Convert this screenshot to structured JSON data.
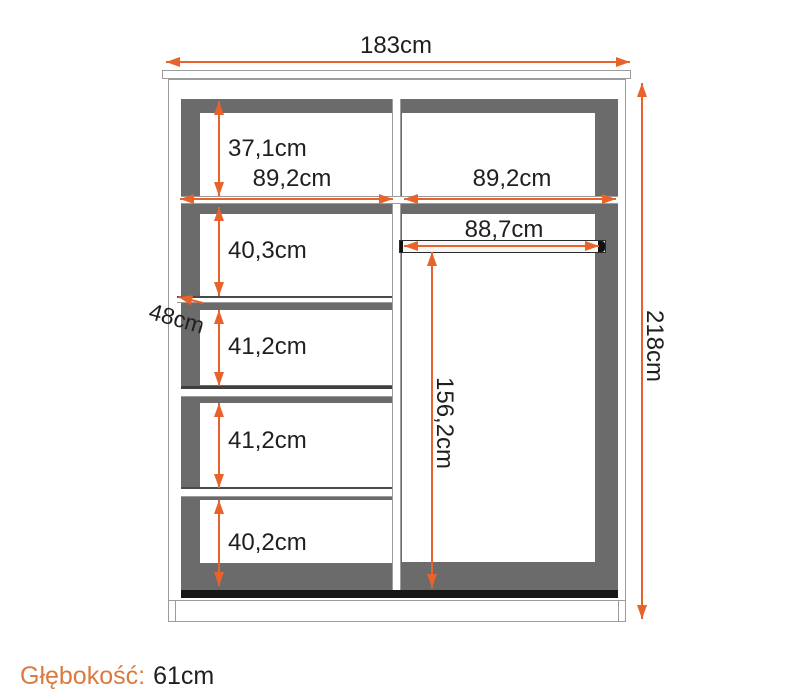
{
  "colors": {
    "accent": "#E8632C",
    "footer_accent": "#DB7A3E",
    "interior_gray": "#6B6B6B",
    "outline_gray": "#9C9C9C",
    "base_black": "#161616",
    "text": "#1F1F1F"
  },
  "dimensions": {
    "overall_width": "183cm",
    "overall_height": "218cm",
    "shelf_depth": "48cm",
    "left_column_width": "89,2cm",
    "right_column_width": "89,2cm",
    "rail_width": "88,7cm",
    "hanging_height": "156,2cm",
    "left_sections": [
      "37,1cm",
      "40,3cm",
      "41,2cm",
      "41,2cm",
      "40,2cm"
    ]
  },
  "footer": {
    "depth_label": "Głębokość:",
    "depth_value": "61cm"
  }
}
